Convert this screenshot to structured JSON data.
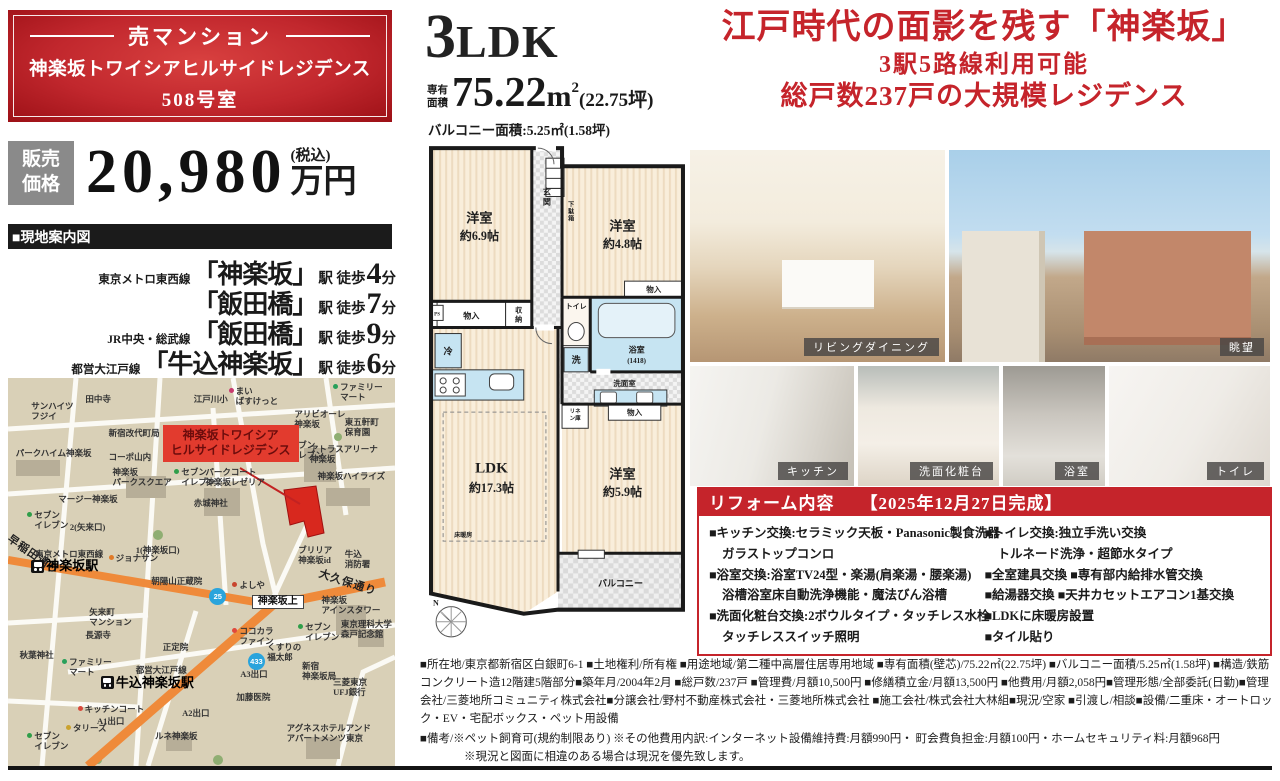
{
  "title_box": {
    "category": "売マンション",
    "building": "神楽坂トワイシアヒルサイドレジデンス",
    "room": "508号室"
  },
  "price": {
    "label_line1": "販売",
    "label_line2": "価格",
    "value": "20,980",
    "tax": "(税込)",
    "unit": "万円"
  },
  "guide": {
    "header": "■現地案内図"
  },
  "access": {
    "stations": [
      {
        "line": "東京メトロ東西線",
        "name": "「神楽坂」",
        "mid": "駅 徒歩",
        "minutes": "4",
        "unit": "分"
      },
      {
        "line": "",
        "name": "「飯田橋」",
        "mid": "駅 徒歩",
        "minutes": "7",
        "unit": "分"
      },
      {
        "line": "JR中央・総武線",
        "name": "「飯田橋」",
        "mid": "駅 徒歩",
        "minutes": "9",
        "unit": "分"
      },
      {
        "line": "都営大江戸線",
        "name": "「牛込神楽坂」",
        "mid": "駅 徒歩",
        "minutes": "6",
        "unit": "分"
      }
    ]
  },
  "unit": {
    "layout_num": "3",
    "layout_suffix": "LDK",
    "area_label1": "専有",
    "area_label2": "面積",
    "area_value": "75.22",
    "area_unit": "m",
    "area_sup": "2",
    "area_tsubo": "(22.75坪)",
    "balcony": "バルコニー面積:5.25㎡(1.58坪)"
  },
  "headline": {
    "line1": "江戸時代の面影を残す「神楽坂」",
    "line2": "3駅5路線利用可能",
    "line3": "総戸数237戸の大規模レジデンス",
    "accent_color": "#c5242b"
  },
  "photos": [
    {
      "label": "リビングダイニング"
    },
    {
      "label": "眺望"
    },
    {
      "label": "キッチン"
    },
    {
      "label": "洗面化粧台"
    },
    {
      "label": "浴室"
    },
    {
      "label": "トイレ"
    }
  ],
  "reform": {
    "title": "リフォーム内容",
    "completion": "【2025年12月27日完成】",
    "left": [
      "■キッチン交換:セラミック天板・Panasonic製食洗器",
      "ガラストップコンロ",
      "■浴室交換:浴室TV24型・楽湯(肩楽湯・腰楽湯)",
      "浴槽浴室床自動洗浄機能・魔法びん浴槽",
      "■洗面化粧台交換:2ボウルタイプ・タッチレス水栓",
      "タッチレススイッチ照明"
    ],
    "right": [
      "■トイレ交換:独立手洗い交換",
      "トルネード洗浄・超節水タイプ",
      "■全室建具交換 ■専有部内給排水管交換",
      "■給湯器交換 ■天井カセットエアコン1基交換",
      "■LDKに床暖房設置",
      "■タイル貼り"
    ]
  },
  "details": {
    "line1": "■所在地/東京都新宿区白銀町6-1 ■土地権利/所有権 ■用途地域/第二種中高層住居専用地域 ■専有面積(壁芯)/75.22㎡(22.75坪) ■バルコニー面積/5.25㎡(1.58坪) ■構造/鉄筋コンクリート造12階建5階部分■築年月/2004年2月 ■総戸数/237戸 ■管理費/月額10,500円 ■修繕積立金/月額13,500円 ■他費用/月額2,058円■管理形態/全部委託(日勤)■管理会社/三菱地所コミュニティ株式会社■分譲会社/野村不動産株式会社・三菱地所株式会社 ■施工会社/株式会社大林組■現況/空家 ■引渡し/相談■設備/二重床・オートロック・EV・宅配ボックス・ペット用設備",
    "line2": "■備考/※ペット飼育可(規約制限あり) ※その他費用内訳:インターネット設備維持費:月額990円・ 町会費負担金:月額100円・ホームセキュリティ料:月額968円",
    "line3": "※現況と図面に相違のある場合は現況を優先致します。"
  },
  "floor_plan": {
    "rooms": {
      "bed1": "洋室",
      "bed1_size": "約6.9帖",
      "bed2": "洋室",
      "bed2_size": "約4.8帖",
      "bed3": "洋室",
      "bed3_size": "約5.9帖",
      "ldk": "LDK",
      "ldk_size": "約17.3帖",
      "genkan1": "玄",
      "genkan2": "関",
      "geta1": "下",
      "geta2": "駄",
      "geta3": "箱",
      "monoire": "物入",
      "shuno1": "収",
      "shuno2": "納",
      "ps": "PS",
      "toilet": "トイレ",
      "bath": "浴室",
      "bath_size": "(1418)",
      "rei": "冷",
      "sen": "洗",
      "senmen": "洗面室",
      "linen1": "リネ",
      "linen2": "ン庫",
      "yukadan": "床暖房",
      "balcony": "バルコニー",
      "compass": "N"
    }
  },
  "map": {
    "subject": {
      "line1": "神楽坂トワイシア",
      "line2": "ヒルサイドレジデンス"
    },
    "route_badges": [
      "25",
      "433"
    ],
    "pois": [
      {
        "t": "田中寺",
        "x": 20,
        "y": 4
      },
      {
        "t": "サンハイツ\nフジイ",
        "x": 6,
        "y": 6
      },
      {
        "t": "江戸川小",
        "x": 48,
        "y": 4
      },
      {
        "t": "まい\nばすけっと",
        "x": 57,
        "y": 2,
        "d": "#c83a6e"
      },
      {
        "t": "ファミリー\nマート",
        "x": 84,
        "y": 1,
        "d": "#28a05a"
      },
      {
        "t": "新宿改代町局",
        "x": 26,
        "y": 13
      },
      {
        "t": "パークハイム神楽坂",
        "x": 2,
        "y": 18
      },
      {
        "t": "コーポ山内",
        "x": 26,
        "y": 19
      },
      {
        "t": "アリビオーレ\n神楽坂",
        "x": 74,
        "y": 8
      },
      {
        "t": "東五軒町\n保育園",
        "x": 87,
        "y": 10
      },
      {
        "t": "神楽坂\nパークスクエア",
        "x": 27,
        "y": 23
      },
      {
        "t": "セブン\nイレブン",
        "x": 43,
        "y": 23,
        "d": "#2f9e49"
      },
      {
        "t": "セブン\nイレブン",
        "x": 71,
        "y": 16,
        "d": "#2f9e49"
      },
      {
        "t": "アトラスアリーナ\n神楽坂",
        "x": 78,
        "y": 17
      },
      {
        "t": "神楽坂ハイライズ",
        "x": 80,
        "y": 24
      },
      {
        "t": "マージー神楽坂",
        "x": 13,
        "y": 30
      },
      {
        "t": "パークコート\n神楽坂レゼリア",
        "x": 51,
        "y": 23
      },
      {
        "t": "赤城神社",
        "x": 48,
        "y": 31
      },
      {
        "t": "セブン\nイレブン",
        "x": 5,
        "y": 34,
        "d": "#2f9e49"
      },
      {
        "t": "ブリリア\n神楽坂id",
        "x": 75,
        "y": 43
      },
      {
        "t": "牛込\n消防署",
        "x": 87,
        "y": 44
      },
      {
        "t": "早稲田通り",
        "x": 1,
        "y": 40,
        "r": 35,
        "big": true
      },
      {
        "t": "2(矢来口)",
        "x": 16,
        "y": 37
      },
      {
        "t": "東京メトロ東西線",
        "x": 7,
        "y": 44
      },
      {
        "t": "神楽坂駅",
        "x": 6,
        "y": 46.5,
        "st": true
      },
      {
        "t": "ジョナサン",
        "x": 26,
        "y": 45,
        "d": "#e07a28"
      },
      {
        "t": "1(神楽坂口)",
        "x": 33,
        "y": 43
      },
      {
        "t": "朝陽山正蔵院",
        "x": 37,
        "y": 51
      },
      {
        "t": "大久保通り",
        "x": 81,
        "y": 49,
        "r": 18,
        "big": true
      },
      {
        "t": "よしや",
        "x": 58,
        "y": 52,
        "d": "#c8452e"
      },
      {
        "t": "矢来町\nマンション",
        "x": 21,
        "y": 59
      },
      {
        "t": "神楽坂上",
        "x": 63,
        "y": 56,
        "box": true
      },
      {
        "t": "神楽坂\nアインスタワー",
        "x": 81,
        "y": 56
      },
      {
        "t": "ファミリー\nマート",
        "x": 14,
        "y": 72,
        "d": "#28a05a"
      },
      {
        "t": "秋葉神社",
        "x": 3,
        "y": 70
      },
      {
        "t": "長源寺",
        "x": 20,
        "y": 65
      },
      {
        "t": "正定院",
        "x": 40,
        "y": 68
      },
      {
        "t": "ココカラ\nファイン",
        "x": 58,
        "y": 64,
        "d": "#e0483c"
      },
      {
        "t": "セブン\nイレブン",
        "x": 75,
        "y": 63,
        "d": "#2f9e49"
      },
      {
        "t": "東京理科大学\n森戸記念館",
        "x": 86,
        "y": 62
      },
      {
        "t": "くすりの\n福太郎",
        "x": 67,
        "y": 68
      },
      {
        "t": "A3出口",
        "x": 60,
        "y": 75
      },
      {
        "t": "新宿\n神楽坂局",
        "x": 76,
        "y": 73
      },
      {
        "t": "三菱東京\nUFJ銀行",
        "x": 84,
        "y": 77
      },
      {
        "t": "都営大江戸線",
        "x": 33,
        "y": 74
      },
      {
        "t": "牛込神楽坂駅",
        "x": 24,
        "y": 76.5,
        "st": true
      },
      {
        "t": "キッチンコート",
        "x": 18,
        "y": 84,
        "d": "#d8483a"
      },
      {
        "t": "A1出口",
        "x": 23,
        "y": 87
      },
      {
        "t": "A2出口",
        "x": 45,
        "y": 85
      },
      {
        "t": "タリーズ",
        "x": 15,
        "y": 89,
        "d": "#caa22e"
      },
      {
        "t": "加藤医院",
        "x": 59,
        "y": 81
      },
      {
        "t": "セブン\nイレブン",
        "x": 5,
        "y": 91,
        "d": "#2f9e49"
      },
      {
        "t": "ルネ神楽坂",
        "x": 38,
        "y": 91
      },
      {
        "t": "アグネスホテルアンド\nアパートメンツ東京",
        "x": 72,
        "y": 89
      }
    ]
  }
}
